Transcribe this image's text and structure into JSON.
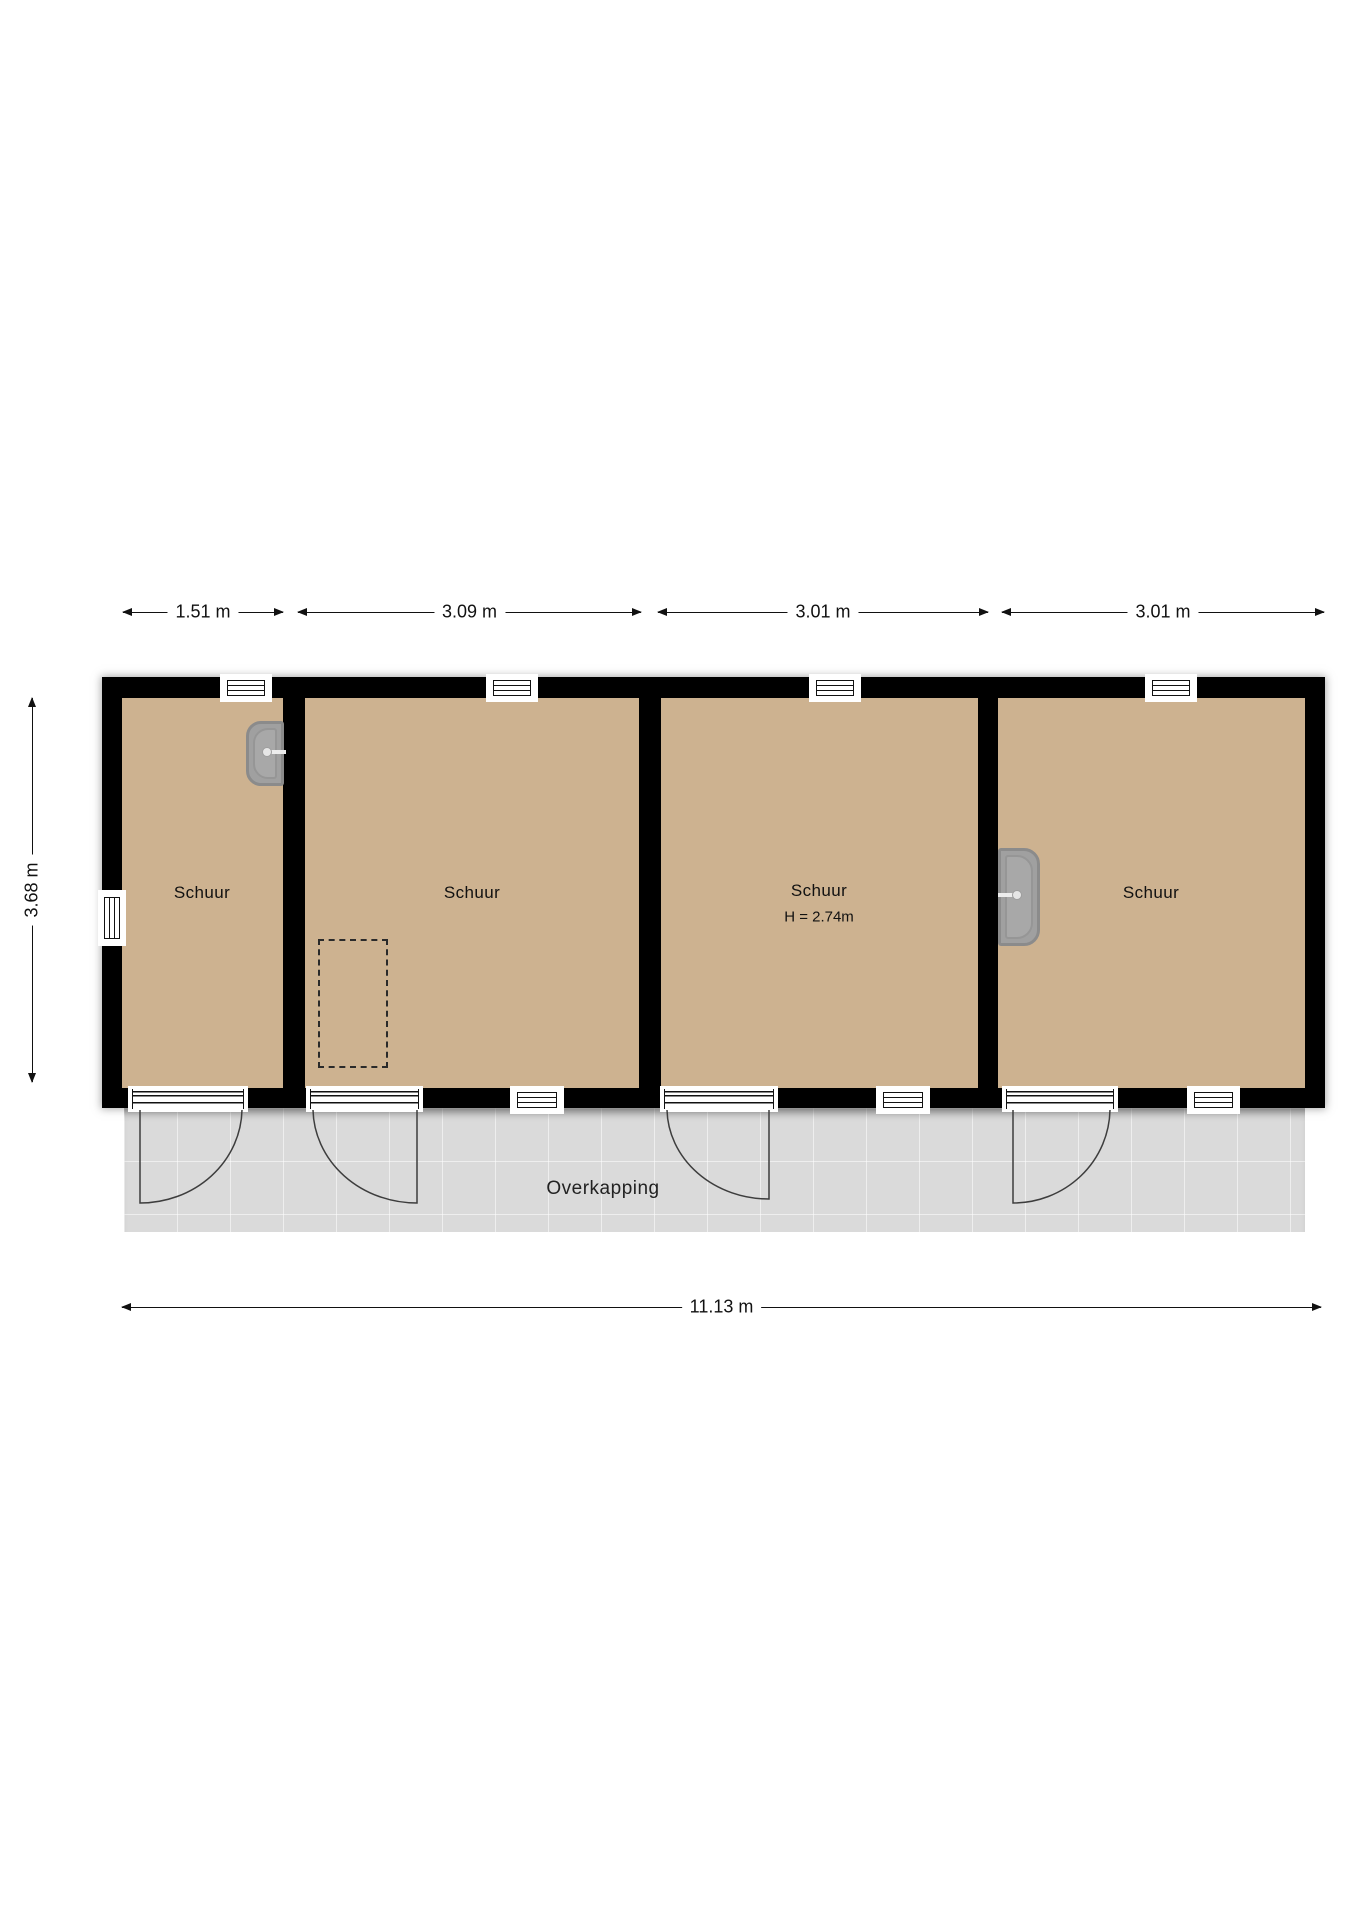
{
  "plan": {
    "rooms": [
      {
        "label": "Schuur"
      },
      {
        "label": "Schuur"
      },
      {
        "label": "Schuur",
        "height_note": "H = 2.74m"
      },
      {
        "label": "Schuur"
      }
    ],
    "canopy": {
      "label": "Overkapping"
    },
    "dimensions": {
      "top": [
        {
          "label": "1.51 m"
        },
        {
          "label": "3.09 m"
        },
        {
          "label": "3.01 m"
        },
        {
          "label": "3.01 m"
        }
      ],
      "left": {
        "label": "3.68 m"
      },
      "bottom": {
        "label": "11.13 m"
      }
    },
    "fixtures": [
      {
        "name": "water-heater",
        "room": 1
      },
      {
        "name": "water-heater",
        "room": 4
      },
      {
        "name": "dashed-outline",
        "room": 2
      }
    ],
    "colors": {
      "wall": "#000000",
      "floor": "#cdb290",
      "canopy": "#dadada",
      "boiler": "#a0a0a0",
      "line": "#111111",
      "page": "#ffffff"
    }
  }
}
